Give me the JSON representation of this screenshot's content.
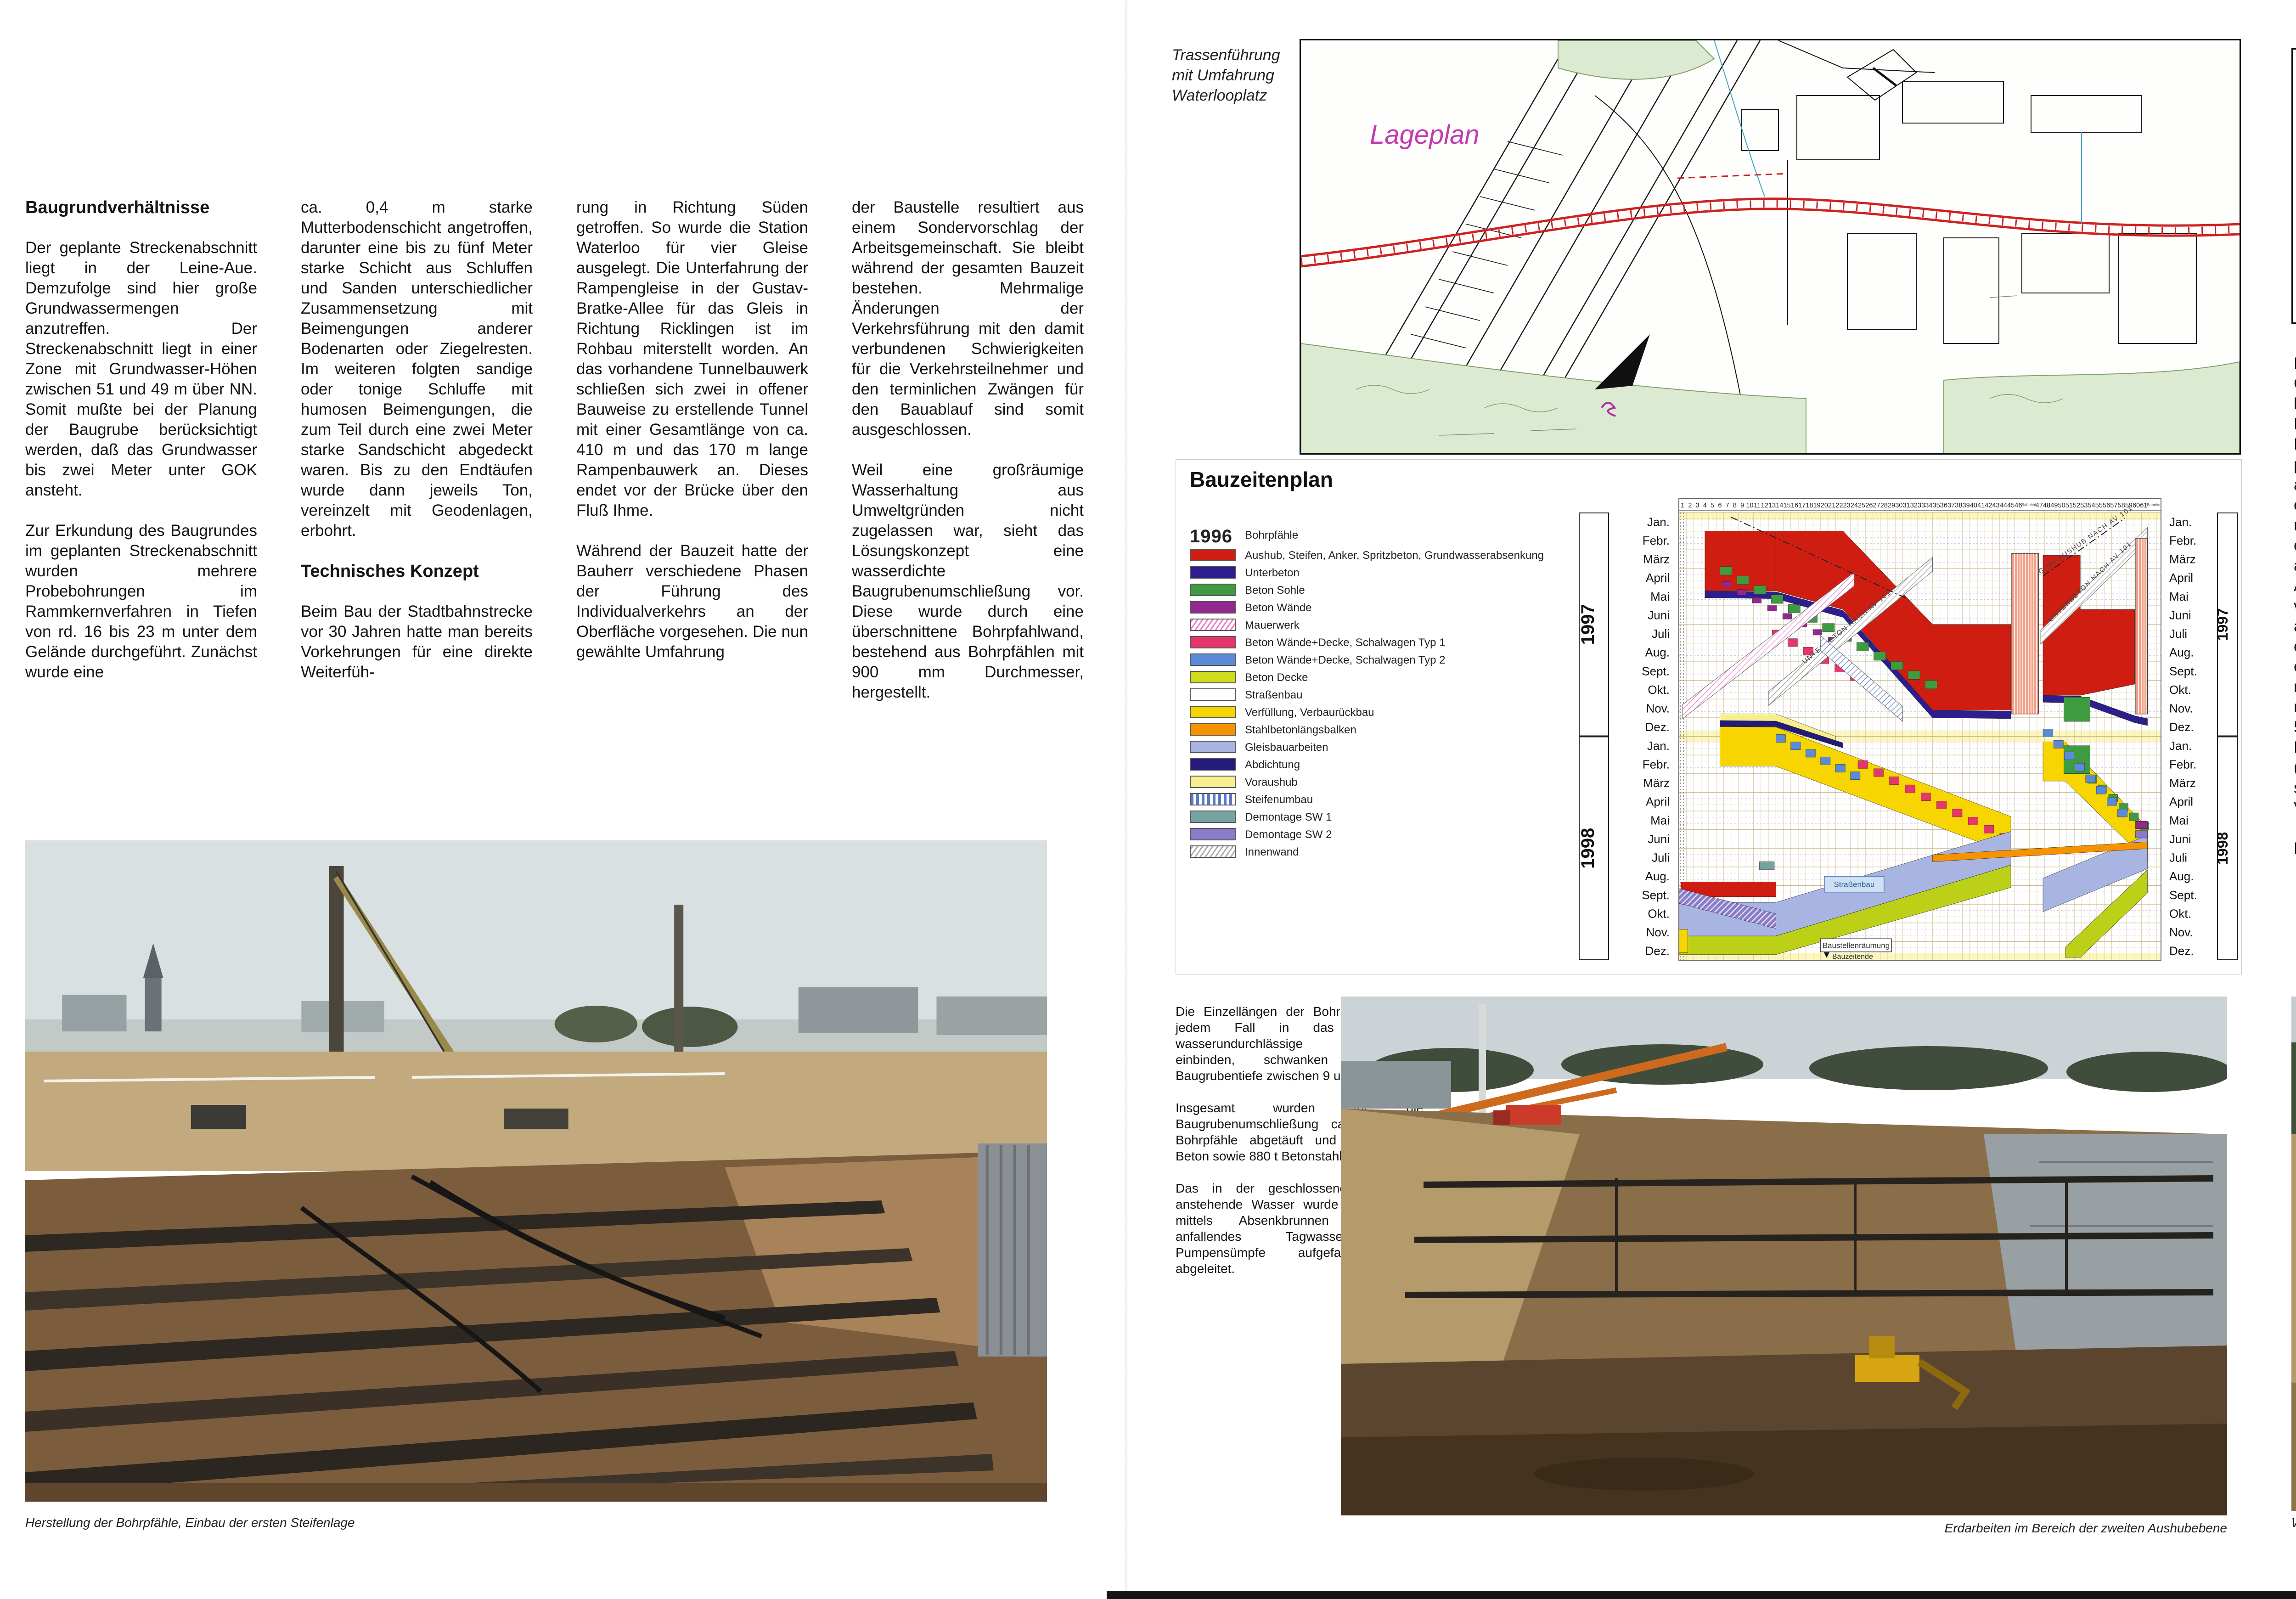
{
  "left": {
    "heading": "Baugrundverhältnisse",
    "c1p1": "Der geplante Streckenabschnitt liegt in der Leine-Aue. Demzufolge sind hier große Grundwassermengen anzutreffen. Der Streckenabschnitt liegt in einer Zone mit Grundwasser-Höhen zwischen 51 und 49 m über NN. Somit mußte bei der Planung der Baugrube berücksichtigt werden, daß das Grundwasser bis zwei Meter unter GOK ansteht.",
    "c1p2": "Zur Erkundung des Baugrundes im geplanten Streckenabschnitt wurden mehrere Probebohrungen im Rammkernverfahren in Tiefen von rd. 16 bis 23 m unter dem Gelände durchgeführt. Zunächst wurde eine",
    "c2p1": "ca. 0,4 m starke Mutterbodenschicht angetroffen, darunter eine bis zu fünf Meter starke Schicht aus Schluffen und Sanden unterschiedlicher Zusammensetzung mit Beimengungen anderer Bodenarten oder Ziegelresten. Im weiteren folgten sandige oder tonige Schluffe mit humosen Beimengungen, die zum Teil durch eine zwei Meter starke Sandschicht abgedeckt waren. Bis zu den Endtäufen wurde dann jeweils Ton, vereinzelt mit Geodenlagen, erbohrt.",
    "heading2": "Technisches Konzept",
    "c2p2": "Beim Bau der Stadtbahnstrecke vor 30 Jahren hatte man bereits Vorkehrungen für eine direkte Weiterfüh-",
    "c3p1": "rung in Richtung Süden getroffen. So wurde die Station Waterloo für vier Gleise ausgelegt. Die Unterfahrung der Rampengleise in der Gustav-Bratke-Allee für das Gleis in Richtung Ricklingen ist im Rohbau miterstellt worden. An das vorhandene Tunnelbauwerk schließen sich zwei in offener Bauweise zu erstellende Tunnel mit einer Gesamtlänge von ca. 410 m und das 170 m lange Rampenbauwerk an. Dieses endet vor der Brücke über den Fluß Ihme.",
    "c3p2": "Während der Bauzeit hatte der Bauherr verschiedene Phasen der Führung des Individualverkehrs an der Oberfläche vorgesehen. Die nun gewählte Umfahrung",
    "c4p1": "der Baustelle resultiert aus einem Sondervorschlag der Arbeitsgemeinschaft. Sie bleibt während der gesamten Bauzeit bestehen. Mehrmalige Änderungen der Verkehrsführung mit den damit verbundenen Schwierigkeiten für die Verkehrsteilnehmer und den terminlichen Zwängen für den Bauablauf sind somit ausgeschlossen.",
    "c4p2": "Weil eine großräumige Wasserhaltung aus Umweltgründen nicht zugelassen war, sieht das Lösungskonzept eine wasserdichte Baugrubenumschließung vor. Diese wurde durch eine überschnittene Bohrpfahlwand, bestehend aus Bohrpfählen mit 900 mm Durchmesser, hergestellt.",
    "caption": "Herstellung der Bohrpfähle, Einbau der ersten Steifenlage"
  },
  "center": {
    "map_label1": "Trassenführung",
    "map_label2": "mit Umfahrung",
    "map_label3": "Waterlooplatz",
    "lageplan": "Lageplan",
    "midp1": "Die Einzellängen der Bohrpfähle, die in jedem Fall in das weitgehend wasserundurchlässige Grundgebirge einbinden, schwanken je nach Baugrubentiefe zwischen 9 und 26 m.",
    "midp2": "Insgesamt wurden für die Baugrubenumschließung ca. 21.850 m Bohrpfähle abgetäuft und 15.000 cbm Beton sowie 880 t Betonstahl verbaut.",
    "midp3": "Das in der geschlossenen Baugrube anstehende Wasser wurde anschließend mittels Absenkbrunnen abgepumpt, anfallendes Tagwasser durch Pumpensümpfe aufgefangen und abgeleitet.",
    "mid_caption": "Erdarbeiten im Bereich der zweiten Aushubebene"
  },
  "right": {
    "d_bohrpfaehle": "Bohrpfähle",
    "d_aushubebene": "Aushubebene",
    "d_st1": "1.Steifenlage",
    "d_st2": "2.Steifenlage",
    "d_st3": "3.Steifenlage",
    "d_schalwagen": "Schalwagen",
    "d_betonieren": "Betonieren",
    "d_phasen": "in 3 Phasen",
    "d_swd": "Sohle/Wand/Decke",
    "d_verfuellung": "Verfüllung",
    "d_level0": "0,00m",
    "d_level2": "2,05m",
    "a1": "Nach erfolgter Absenkung des Grundwassers konnte mit dem lagenweisen Aushub der Baugrube begonnen werden. Dies erwies sich in sofern problematisch, da die von außen auf die Bohrpfahlwand einwirkenden Kräfte durch mehrlagige Stahlsteifen mit einem Achsabstand von 1,5 m aufgefangen wurden. Der Aushub war somit nur von vorbereiteten Baggerlöchern aus möglich, so daß unter den einzelnen Streifenlagen erhebliche Quertransporte notwendig waren. Insgesamt mußte der Aushub von ca. 50.000 cbm Boden bei einer Baugrubentiefe bis zu 20 m (fünflagige Aussteifung, siebenlagige rückwärtige Verankerung) bewältigt werden.",
    "a2": "Die durch die äußeren Bohr-",
    "b1": "pfahlwände nach außen eingetriebenen Entspannungsbohrungen bewirken eine Reduzierung des Porenwasserdrucks im Ton. Somit konnte die äußere Belastung auf die Bohrpfahlwand gemindert und eine Minimierung der Stahlaussteifung erreicht werden.",
    "bh": "Baudurchführung",
    "b2": "Das Bauwerk wird in Form eines Hohlkastenquerschnittes errichtet. Die Wand- und Deckenstärken erreichen, je nach statischer Belastung, Stärken von 0,60 bis 1,20 m. Da die freie Spannweite bei einigen Blöcken etwa 13 m erreicht, werden in diesen Blöcken Zwischenwände ausgeführt.",
    "b3": "Zur weiteren Stabilisierung des Rahmenquerschnittes",
    "c1": "sind an der Sohle und im Deckenbereich Vouten unterschiedlicher Stärke angeordnet. Für die Aufnahmen der Elektroleitungen für den späteren Stadtbahnbetrieb befinden sich im Wandbereich Kabelnischen. Im Trogbereich anfallendes Niederschlagswasser wird über ein Pumpwerk abgeführt.",
    "c2": "Um den Bauablauf weitestgehend zu optimieren und den Einsatz von Schalwagen zu ermöglichen, entschloß sich die ausführende Arge, das Bauwerk in zwei Abschnitten herzustellen. Im ersten Abschnitt wird die Bauwerksohle durch einen vorlaufenden Voutenwagen bis zu der über der unteren Voute angeordneten Arbeitsfuge betoniert.",
    "caption": "Während der Aushubarbeiten wurde ein prähistorischer Baumstamm gefunden und geborgen"
  },
  "chart_data": {
    "type": "gantt",
    "title": "Bauzeitenplan",
    "years": [
      "1997",
      "1998"
    ],
    "months": [
      "Jan.",
      "Febr.",
      "März",
      "April",
      "Mai",
      "Juni",
      "Juli",
      "Aug.",
      "Sept.",
      "Okt.",
      "Nov.",
      "Dez."
    ],
    "columns": {
      "from": 1,
      "to": 61
    },
    "station_label": "Bahnhof",
    "legend": [
      {
        "year": "1996",
        "label": "Bohrpfähle"
      },
      {
        "color": "#cf1d11",
        "label": "Aushub, Steifen, Anker, Spritzbeton, Grundwasserabsenkung"
      },
      {
        "color": "#2c1e8f",
        "label": "Unterbeton"
      },
      {
        "color": "#3f9b3f",
        "label": "Beton Sohle"
      },
      {
        "color": "#93268f",
        "label": "Beton Wände"
      },
      {
        "pattern": "hatch-pink",
        "label": "Mauerwerk"
      },
      {
        "color": "#e8356e",
        "label": "Beton Wände+Decke, Schalwagen Typ 1"
      },
      {
        "color": "#5b8bd8",
        "label": "Beton Wände+Decke, Schalwagen Typ 2"
      },
      {
        "color": "#cddd1a",
        "label": "Beton Decke"
      },
      {
        "color": "#ffffff",
        "label": "Straßenbau"
      },
      {
        "color": "#f6d500",
        "label": "Verfüllung, Verbaurückbau"
      },
      {
        "color": "#f59300",
        "label": "Stahlbetonlängsbalken"
      },
      {
        "color": "#a8b4e2",
        "label": "Gleisbauarbeiten"
      },
      {
        "color": "#241a7a",
        "label": "Abdichtung"
      },
      {
        "color": "#f7ef8e",
        "label": "Voraushub"
      },
      {
        "pattern": "stripes-blue",
        "label": "Steifenumbau"
      },
      {
        "color": "#76a3a0",
        "label": "Demontage SW 1"
      },
      {
        "color": "#8a7cc8",
        "label": "Demontage SW 2"
      },
      {
        "pattern": "hatch-gray",
        "label": "Innenwand"
      }
    ],
    "stations": [
      [
        44.6,
        2.2,
        46.4,
        10.8
      ],
      [
        59.4,
        1.4,
        61,
        10.8
      ]
    ],
    "yellow_rows": [
      [
        0,
        0.4
      ],
      [
        11.7,
        12.3
      ],
      [
        23.6,
        24
      ]
    ],
    "bands": [
      {
        "k": "poly",
        "c": "#f7ef8e",
        "p": [
          [
            5.5,
            10.8
          ],
          [
            13,
            10.8
          ],
          [
            21,
            12.0
          ],
          [
            21,
            12.5
          ],
          [
            13,
            11.5
          ],
          [
            5.5,
            11.5
          ]
        ]
      },
      {
        "k": "poly",
        "c": "#cf1d11",
        "p": [
          [
            3.5,
            1
          ],
          [
            13,
            1
          ],
          [
            13,
            4.2
          ],
          [
            3.5,
            4.2
          ]
        ]
      },
      {
        "k": "poly",
        "c": "#cf1d11",
        "p": [
          [
            13,
            1
          ],
          [
            22,
            1
          ],
          [
            34,
            6
          ],
          [
            44.5,
            6
          ],
          [
            44.5,
            10.6
          ],
          [
            34,
            10.6
          ],
          [
            22,
            5.2
          ],
          [
            13,
            4.2
          ]
        ]
      },
      {
        "k": "poly",
        "c": "#cf1d11",
        "p": [
          [
            47,
            2.3
          ],
          [
            52,
            2.3
          ],
          [
            52,
            5.2
          ],
          [
            59.3,
            5.2
          ],
          [
            59.3,
            9.2
          ],
          [
            52,
            9.8
          ],
          [
            47,
            9.8
          ]
        ]
      },
      {
        "k": "rect",
        "c": "#cf1d11",
        "r": [
          0.3,
          19.8,
          13,
          20.6
        ]
      },
      {
        "k": "poly",
        "c": "#2c1e8f",
        "p": [
          [
            3.5,
            4.2
          ],
          [
            13,
            4.25
          ],
          [
            22,
            5.25
          ],
          [
            34,
            10.6
          ],
          [
            44.5,
            10.65
          ],
          [
            44.5,
            11.05
          ],
          [
            34,
            11.0
          ],
          [
            22,
            5.62
          ],
          [
            13,
            4.62
          ],
          [
            3.5,
            4.57
          ]
        ]
      },
      {
        "k": "poly",
        "c": "#2c1e8f",
        "p": [
          [
            47,
            9.8
          ],
          [
            52,
            9.85
          ],
          [
            59.3,
            10.9
          ],
          [
            61,
            11.05
          ],
          [
            61,
            11.42
          ],
          [
            59.3,
            11.27
          ],
          [
            52,
            10.22
          ],
          [
            47,
            10.17
          ]
        ]
      },
      {
        "k": "stairs",
        "c": "#3f9b3f",
        "f": [
          5.5,
          2.9
        ],
        "t": [
          33,
          9.0
        ],
        "n": 13,
        "w": 1.6,
        "h": 0.45
      },
      {
        "k": "stairs",
        "c": "#93268f",
        "f": [
          5.8,
          3.7
        ],
        "t": [
          20,
          6.7
        ],
        "n": 8,
        "w": 1.2,
        "h": 0.3
      },
      {
        "k": "stairs",
        "c": "#e8356e",
        "f": [
          12.5,
          6.3
        ],
        "t": [
          23,
          8.6
        ],
        "n": 6,
        "w": 1.3,
        "h": 0.42
      },
      {
        "k": "hband",
        "c": "#e87bc8",
        "f": [
          0.5,
          10.3
        ],
        "t": [
          23.5,
          3.2
        ],
        "w": 0.75
      },
      {
        "k": "hband",
        "c": "#999999",
        "f": [
          12,
          9.6
        ],
        "t": [
          34,
          2.4
        ],
        "w": 0.75,
        "label": "unterbeton"
      },
      {
        "k": "hband",
        "c": "#999999",
        "f": [
          46.7,
          6.3
        ],
        "t": [
          61,
          0.8
        ],
        "w": 0.75,
        "label": "unterbeton"
      },
      {
        "k": "hband",
        "c": "#5b79c8",
        "f": [
          19,
          6.6
        ],
        "t": [
          30,
          10.4
        ],
        "w": 0.8
      },
      {
        "k": "dline",
        "f": [
          7,
          0.25
        ],
        "t": [
          30.5,
          4.6
        ]
      },
      {
        "k": "dline",
        "f": [
          47,
          3.4
        ],
        "t": [
          58,
          0.3
        ],
        "label": "beginn"
      },
      {
        "k": "poly",
        "c": "#241a7a",
        "p": [
          [
            5.5,
            11.15
          ],
          [
            13,
            11.18
          ],
          [
            22,
            12.35
          ],
          [
            22,
            12.62
          ],
          [
            13,
            11.48
          ],
          [
            5.5,
            11.48
          ]
        ]
      },
      {
        "k": "poly",
        "c": "#f6d500",
        "p": [
          [
            5.5,
            11.48
          ],
          [
            13,
            11.5
          ],
          [
            44.5,
            16.3
          ],
          [
            44.5,
            18.3
          ],
          [
            13,
            13.6
          ],
          [
            5.5,
            13.6
          ]
        ]
      },
      {
        "k": "poly",
        "c": "#f6d500",
        "p": [
          [
            47,
            12.3
          ],
          [
            50,
            12.3
          ],
          [
            61,
            16.9
          ],
          [
            61,
            18.7
          ],
          [
            50,
            14.4
          ],
          [
            47,
            14.4
          ]
        ]
      },
      {
        "k": "rect",
        "c": "#3f9b3f",
        "r": [
          49.8,
          9.9,
          53.3,
          11.2
        ]
      },
      {
        "k": "rect",
        "c": "#3f9b3f",
        "r": [
          49.8,
          12.5,
          53.3,
          14.0
        ]
      },
      {
        "k": "stairs",
        "c": "#3f9b3f",
        "f": [
          53,
          14.1
        ],
        "t": [
          60,
          16.6
        ],
        "n": 6,
        "w": 1.2,
        "h": 0.42
      },
      {
        "k": "stairs",
        "c": "#3f9b3f",
        "f": [
          0.5,
          20.7
        ],
        "t": [
          10,
          22.0
        ],
        "n": 5,
        "w": 1.2,
        "h": 0.42
      },
      {
        "k": "stairs",
        "c": "#e8356e",
        "f": [
          24,
          13.3
        ],
        "t": [
          43,
          17.2
        ],
        "n": 10,
        "w": 1.3,
        "h": 0.42
      },
      {
        "k": "stairs",
        "c": "#5b8bd8",
        "f": [
          13,
          11.9
        ],
        "t": [
          23,
          13.9
        ],
        "n": 6,
        "w": 1.3,
        "h": 0.42
      },
      {
        "k": "stairs",
        "c": "#5b8bd8",
        "f": [
          47,
          11.6
        ],
        "t": [
          57,
          15.9
        ],
        "n": 8,
        "w": 1.3,
        "h": 0.42
      },
      {
        "k": "poly",
        "c": "#a8b4e2",
        "p": [
          [
            0,
            20.9
          ],
          [
            13,
            20.9
          ],
          [
            44.5,
            17.1
          ],
          [
            44.5,
            18.9
          ],
          [
            13,
            22.7
          ],
          [
            0,
            22.7
          ]
        ]
      },
      {
        "k": "poly",
        "c": "#a8b4e2",
        "p": [
          [
            47,
            19.6
          ],
          [
            61,
            17.3
          ],
          [
            61,
            19.1
          ],
          [
            47,
            21.4
          ]
        ]
      },
      {
        "k": "poly",
        "c": "#bcd018",
        "p": [
          [
            0,
            22.7
          ],
          [
            13,
            22.7
          ],
          [
            44.5,
            18.9
          ],
          [
            44.5,
            20.1
          ],
          [
            13,
            23.7
          ],
          [
            0,
            23.7
          ]
        ]
      },
      {
        "k": "poly",
        "c": "#bcd018",
        "p": [
          [
            50,
            23.3
          ],
          [
            61,
            19.15
          ],
          [
            61,
            20.4
          ],
          [
            52,
            23.85
          ],
          [
            50,
            23.85
          ]
        ]
      },
      {
        "k": "poly",
        "c": "#8a7cc8",
        "hatch": true,
        "p": [
          [
            0,
            20.15
          ],
          [
            13,
            21.5
          ],
          [
            13,
            22.3
          ],
          [
            0,
            20.95
          ]
        ]
      },
      {
        "k": "poly",
        "c": "#f59300",
        "p": [
          [
            34,
            18.35
          ],
          [
            61,
            17.65
          ],
          [
            61,
            18.02
          ],
          [
            34,
            18.72
          ]
        ]
      },
      {
        "k": "rect",
        "c": "#76a3a0",
        "r": [
          10.8,
          18.72,
          12.8,
          19.15
        ]
      },
      {
        "k": "rect",
        "c": "#93268f",
        "r": [
          59.4,
          16.55,
          61,
          16.95
        ]
      },
      {
        "k": "rect",
        "c": "#8a7cc8",
        "r": [
          59.4,
          17.05,
          61,
          17.45
        ]
      },
      {
        "k": "rect",
        "c": "#f6d500",
        "r": [
          0,
          22.35,
          1.2,
          23.6
        ]
      }
    ],
    "boxes": [
      {
        "textKey": "strassenbau",
        "r": [
          19.5,
          19.5,
          27.5,
          20.35
        ],
        "fill": "#cfe0f5",
        "stroke": "#4a78b8",
        "tc": "#2a5a9a"
      },
      {
        "textKey": "raeumung",
        "r": [
          19,
          22.85,
          28.5,
          23.55
        ],
        "fill": "#ffffff",
        "stroke": "#444444",
        "tc": "#333333"
      }
    ],
    "ende_marker": {
      "textKey": "ende",
      "at": [
        20.3,
        23.92
      ]
    },
    "annotations": {
      "strassenbau": "Straßenbau",
      "raeumung": "Baustellenräumung",
      "ende": "Bauzeitende",
      "unterbeton": "UNTERBETON NACH AV 101",
      "beginn": "BEGINN AUSHUB NACH AV 101"
    }
  }
}
